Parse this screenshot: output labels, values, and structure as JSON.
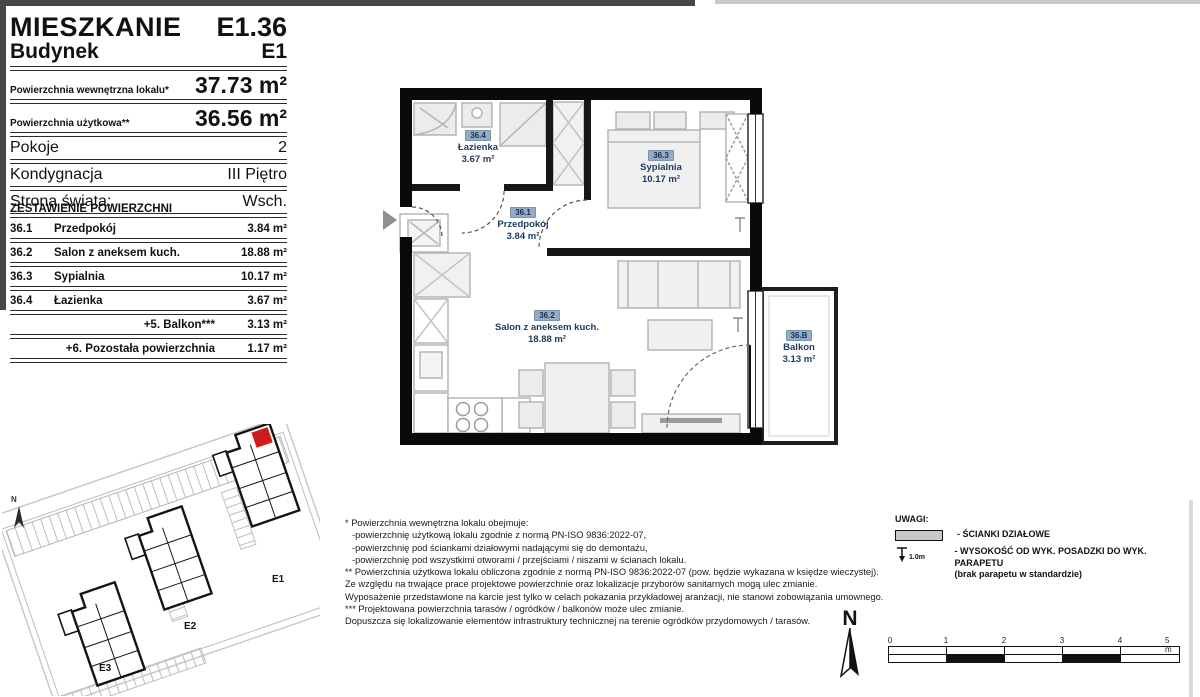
{
  "header": {
    "title_label": "MIESZKANIE",
    "title_value": "E1.36",
    "building_label": "Budynek",
    "building_value": "E1",
    "metrics": [
      {
        "label": "Powierzchnia wewnętrzna lokalu*",
        "value": "37.73 m²"
      },
      {
        "label": "Powierzchnia użytkowa**",
        "value": "36.56 m²"
      },
      {
        "label": "Pokoje",
        "value": "2"
      },
      {
        "label": "Kondygnacja",
        "value": "III Piętro"
      },
      {
        "label": "Strona świata:",
        "value": "Wsch."
      }
    ]
  },
  "area_table": {
    "title": "ZESTAWIENIE POWIERZCHNI",
    "rows": [
      {
        "no": "36.1",
        "name": "Przedpokój",
        "value": "3.84 m²"
      },
      {
        "no": "36.2",
        "name": "Salon z aneksem kuch.",
        "value": "18.88 m²"
      },
      {
        "no": "36.3",
        "name": "Sypialnia",
        "value": "10.17 m²"
      },
      {
        "no": "36.4",
        "name": "Łazienka",
        "value": "3.67 m²"
      },
      {
        "no": "",
        "name": "+5. Balkon***",
        "value": "3.13 m²"
      },
      {
        "no": "",
        "name": "+6. Pozostała powierzchnia",
        "value": "1.17 m²"
      }
    ]
  },
  "plan": {
    "rooms": [
      {
        "id": "36.4",
        "name": "Łazienka",
        "area": "3.67 m²"
      },
      {
        "id": "36.1",
        "name": "Przedpokój",
        "area": "3.84 m²"
      },
      {
        "id": "36.3",
        "name": "Sypialnia",
        "area": "10.17 m²"
      },
      {
        "id": "36.2",
        "name": "Salon z aneksem kuch.",
        "area": "18.88 m²"
      },
      {
        "id": "36.B",
        "name": "Balkon",
        "area": "3.13 m²"
      }
    ]
  },
  "site_plan": {
    "buildings": [
      "E1",
      "E2",
      "E3"
    ],
    "north_label": "N",
    "highlight_color": "#cf1b1b"
  },
  "footnotes": [
    "* Powierzchnia wewnętrzna lokalu obejmuje:",
    "-powierzchnię użytkową lokalu zgodnie z normą PN-ISO 9836:2022-07,",
    "-powierzchnię pod ściankami działowymi nadającymi się do demontażu,",
    "-powierzchnię pod wszystkimi otworami / przejściami / niszami w ścianach lokalu.",
    "** Powierzchnia użytkowa lokalu obliczona zgodnie z normą PN-ISO 9836:2022-07 (pow. będzie wykazana w księdze wieczystej).",
    "Ze względu na trwające prace projektowe powierzchnie oraz lokalizacje przyborów sanitarnych mogą ulec zmianie.",
    "Wyposażenie przedstawione na karcie jest tylko w celach pokazania przykładowej aranżacji, nie stanowi zobowiązania umownego.",
    "*** Projektowana powierzchnia tarasów / ogródków / balkonów może ulec zmianie.",
    "Dopuszcza się lokalizowanie elementów infrastruktury technicznej na terenie ogródków przydomowych / tarasów."
  ],
  "legend": {
    "title": "UWAGI:",
    "items": [
      {
        "symbol": "partition-wall",
        "label": "- ŚCIANKI DZIAŁOWE"
      },
      {
        "symbol": "sill-height",
        "symbol_text": "1.0m",
        "label": "- WYSOKOŚĆ OD WYK. POSADZKI DO WYK. PARAPETU",
        "sublabel": "(brak parapetu w standardzie)"
      }
    ]
  },
  "compass": {
    "north_label": "N"
  },
  "scale_bar": {
    "ticks": [
      "0",
      "1",
      "2",
      "3",
      "4",
      "5 m"
    ]
  },
  "colors": {
    "wall": "#0a0a0a",
    "badge_bg": "#96adc1",
    "badge_text": "#12305a",
    "room_label_text": "#1c3a5e",
    "highlight_unit": "#cf1b1b"
  }
}
